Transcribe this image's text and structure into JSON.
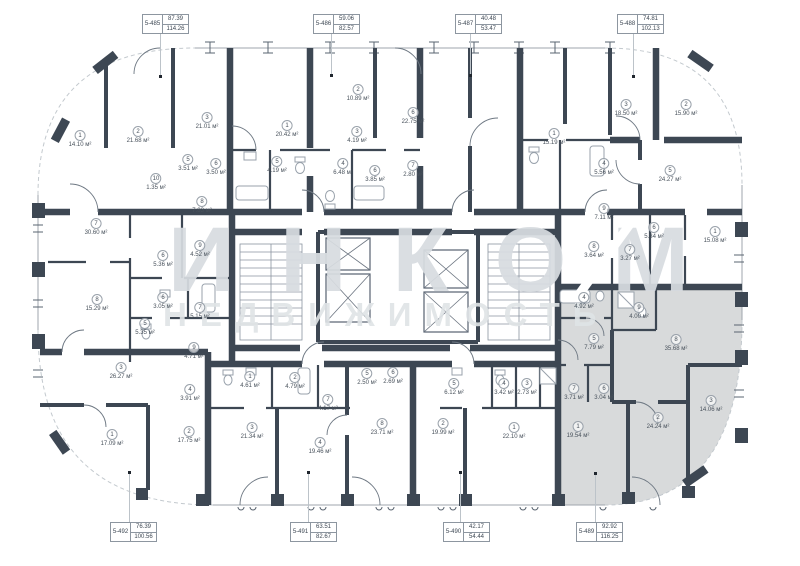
{
  "watermark": {
    "line1": "ИНКОМ",
    "line2": "НЕДВИЖИМОСТЬ"
  },
  "colors": {
    "wall": "#3d4753",
    "partition": "#3d4753",
    "glass": "#9fa6ad",
    "fixture": "#98a1ab",
    "highlight_fill": "#d8dadb",
    "label_text": "#49525c",
    "leader": "#bcc3c9"
  },
  "units": [
    {
      "id": "5-485",
      "area1": "87.39",
      "area2": "114.26",
      "side": "top",
      "x": 142,
      "line_x": 160,
      "dot_y": 76
    },
    {
      "id": "5-486",
      "area1": "59.06",
      "area2": "82.57",
      "side": "top",
      "x": 313,
      "line_x": 331,
      "dot_y": 75
    },
    {
      "id": "5-487",
      "area1": "40.48",
      "area2": "53.47",
      "side": "top",
      "x": 455,
      "line_x": 470,
      "dot_y": 75
    },
    {
      "id": "5-488",
      "area1": "74.81",
      "area2": "102.13",
      "side": "top",
      "x": 617,
      "line_x": 633,
      "dot_y": 76
    },
    {
      "id": "5-492",
      "area1": "76.39",
      "area2": "100.56",
      "side": "bottom",
      "x": 110,
      "line_x": 129,
      "dot_y": 472
    },
    {
      "id": "5-491",
      "area1": "63.51",
      "area2": "82.67",
      "side": "bottom",
      "x": 290,
      "line_x": 308,
      "dot_y": 472
    },
    {
      "id": "5-490",
      "area1": "42.17",
      "area2": "54.44",
      "side": "bottom",
      "x": 443,
      "line_x": 460,
      "dot_y": 472
    },
    {
      "id": "5-489",
      "area1": "92.92",
      "area2": "116.25",
      "side": "bottom",
      "x": 576,
      "line_x": 595,
      "dot_y": 473
    }
  ],
  "rooms": [
    {
      "n": "1",
      "area": "14.10 м²",
      "x": 80,
      "y": 136
    },
    {
      "n": "2",
      "area": "21.68 м²",
      "x": 138,
      "y": 132
    },
    {
      "n": "3",
      "area": "21.01 м²",
      "x": 207,
      "y": 118
    },
    {
      "n": "5",
      "area": "3.51 м²",
      "x": 188,
      "y": 160
    },
    {
      "n": "6",
      "area": "3.50 м²",
      "x": 216,
      "y": 164
    },
    {
      "n": "10",
      "area": "1.35 м²",
      "x": 156,
      "y": 179
    },
    {
      "n": "8",
      "area": "7.83 м²",
      "x": 202,
      "y": 202
    },
    {
      "n": "9",
      "area": "4.52 м²",
      "x": 200,
      "y": 246
    },
    {
      "n": "6",
      "area": "5.36 м²",
      "x": 163,
      "y": 256
    },
    {
      "n": "7",
      "area": "30.60 м²",
      "x": 96,
      "y": 224
    },
    {
      "n": "8",
      "area": "15.29 м²",
      "x": 97,
      "y": 300
    },
    {
      "n": "6",
      "area": "3.05 м²",
      "x": 163,
      "y": 298
    },
    {
      "n": "7",
      "area": "5.15 м²",
      "x": 200,
      "y": 308
    },
    {
      "n": "5",
      "area": "5.35 м²",
      "x": 145,
      "y": 324
    },
    {
      "n": "9",
      "area": "4.71 м²",
      "x": 194,
      "y": 348
    },
    {
      "n": "3",
      "area": "26.27 м²",
      "x": 121,
      "y": 368
    },
    {
      "n": "4",
      "area": "3.91 м²",
      "x": 190,
      "y": 390
    },
    {
      "n": "1",
      "area": "17.09 м²",
      "x": 112,
      "y": 435
    },
    {
      "n": "2",
      "area": "17.75 м²",
      "x": 189,
      "y": 432
    },
    {
      "n": "1",
      "area": "20.42 м²",
      "x": 287,
      "y": 126
    },
    {
      "n": "2",
      "area": "10.89 м²",
      "x": 358,
      "y": 90
    },
    {
      "n": "3",
      "area": "4.19 м²",
      "x": 357,
      "y": 132
    },
    {
      "n": "5",
      "area": "4.19 м²",
      "x": 277,
      "y": 162
    },
    {
      "n": "4",
      "area": "6.48 м²",
      "x": 343,
      "y": 164
    },
    {
      "n": "6",
      "area": "3.85 м²",
      "x": 375,
      "y": 171
    },
    {
      "n": "6",
      "area": "22.75 м²",
      "x": 413,
      "y": 113
    },
    {
      "n": "7",
      "area": "2.80 м²",
      "x": 413,
      "y": 166
    },
    {
      "n": "1",
      "area": "15.19 м²",
      "x": 554,
      "y": 134
    },
    {
      "n": "3",
      "area": "18.50 м²",
      "x": 626,
      "y": 105
    },
    {
      "n": "2",
      "area": "15.90 м²",
      "x": 686,
      "y": 105
    },
    {
      "n": "4",
      "area": "5.56 м²",
      "x": 604,
      "y": 164
    },
    {
      "n": "5",
      "area": "24.27 м²",
      "x": 670,
      "y": 171
    },
    {
      "n": "9",
      "area": "7.11 м²",
      "x": 604,
      "y": 209
    },
    {
      "n": "6",
      "area": "5.34 м²",
      "x": 654,
      "y": 228
    },
    {
      "n": "8",
      "area": "3.64 м²",
      "x": 594,
      "y": 247
    },
    {
      "n": "7",
      "area": "3.27 м²",
      "x": 630,
      "y": 250
    },
    {
      "n": "1",
      "area": "15.08 м²",
      "x": 715,
      "y": 232
    },
    {
      "n": "1",
      "area": "4.61 м²",
      "x": 250,
      "y": 377
    },
    {
      "n": "2",
      "area": "4.79 м²",
      "x": 295,
      "y": 378
    },
    {
      "n": "5",
      "area": "2.50 м²",
      "x": 367,
      "y": 374
    },
    {
      "n": "6",
      "area": "2.69 м²",
      "x": 393,
      "y": 373
    },
    {
      "n": "7",
      "area": "4.17 м²",
      "x": 328,
      "y": 400
    },
    {
      "n": "3",
      "area": "21.34 м²",
      "x": 252,
      "y": 428
    },
    {
      "n": "4",
      "area": "19.46 м²",
      "x": 320,
      "y": 443
    },
    {
      "n": "8",
      "area": "23.71 м²",
      "x": 382,
      "y": 424
    },
    {
      "n": "5",
      "area": "6.12 м²",
      "x": 454,
      "y": 384
    },
    {
      "n": "4",
      "area": "3.42 м²",
      "x": 504,
      "y": 384
    },
    {
      "n": "3",
      "area": "2.73 м²",
      "x": 527,
      "y": 384
    },
    {
      "n": "1",
      "area": "22.10 м²",
      "x": 514,
      "y": 428
    },
    {
      "n": "2",
      "area": "19.99 м²",
      "x": 443,
      "y": 424
    },
    {
      "n": "4",
      "area": "4.92 м²",
      "x": 584,
      "y": 298
    },
    {
      "n": "9",
      "area": "4.00 м²",
      "x": 639,
      "y": 308
    },
    {
      "n": "5",
      "area": "7.79 м²",
      "x": 594,
      "y": 339
    },
    {
      "n": "8",
      "area": "35.68 м²",
      "x": 676,
      "y": 340
    },
    {
      "n": "7",
      "area": "3.71 м²",
      "x": 574,
      "y": 389
    },
    {
      "n": "6",
      "area": "3.04 м²",
      "x": 604,
      "y": 389
    },
    {
      "n": "1",
      "area": "19.54 м²",
      "x": 578,
      "y": 427
    },
    {
      "n": "2",
      "area": "24.24 м²",
      "x": 658,
      "y": 418
    },
    {
      "n": "3",
      "area": "14.06 м²",
      "x": 711,
      "y": 401
    }
  ]
}
